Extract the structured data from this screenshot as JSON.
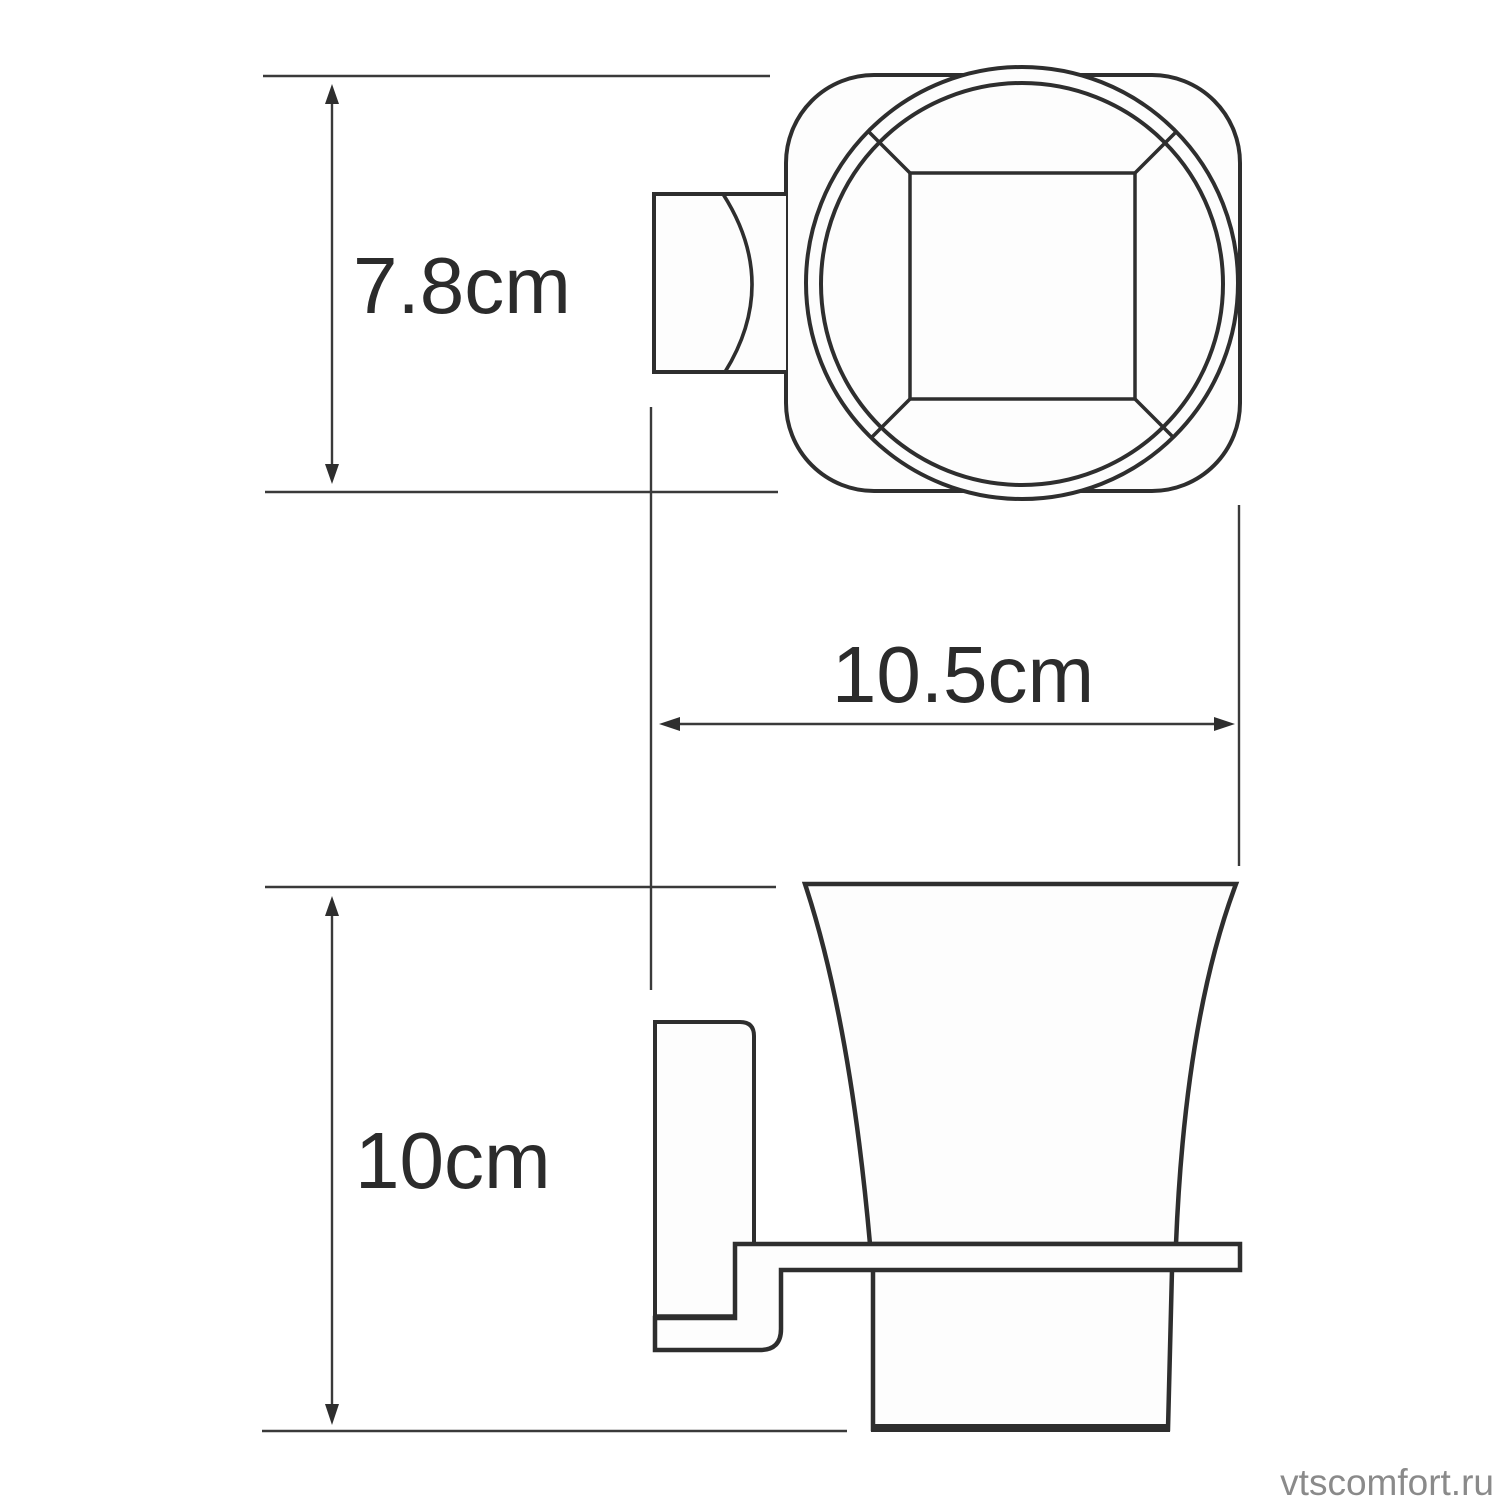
{
  "dims": {
    "height_top": {
      "label": "7.8cm"
    },
    "width": {
      "label": "10.5cm"
    },
    "height_side": {
      "label": "10cm"
    }
  },
  "watermark": {
    "text": "vtscomfort.ru",
    "color": "#8a8a8a"
  },
  "colors": {
    "line": "#2e2e2e",
    "dimension_line": "#3a3a3a",
    "text": "#2b2b2b",
    "fill": "#fdfdfd",
    "background": "#ffffff"
  }
}
